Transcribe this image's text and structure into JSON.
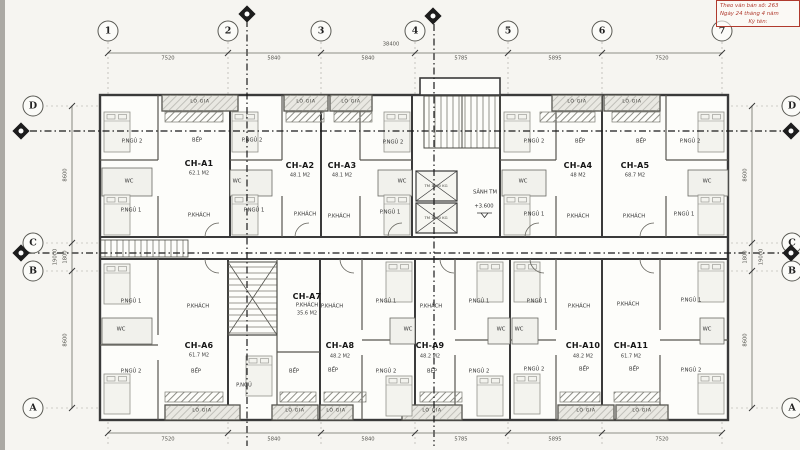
{
  "stamp": {
    "line1": "Theo văn bản số: 263",
    "line2": "Ngày 24 tháng 4 năm",
    "line3": "Ký tên:"
  },
  "grid": {
    "cols": [
      "1",
      "2",
      "3",
      "4",
      "5",
      "6",
      "7"
    ],
    "rows": [
      "D",
      "C",
      "B",
      "A"
    ],
    "col_dims": [
      "7520",
      "5840",
      "5840",
      "5785",
      "5895",
      "7520"
    ],
    "col_total": "38400",
    "row_dims": [
      "8600",
      "1800",
      "8600"
    ],
    "row_total": "19000"
  },
  "units": [
    {
      "id": "CH-A1",
      "area": "62.1 M2"
    },
    {
      "id": "CH-A2",
      "area": "48.1 M2"
    },
    {
      "id": "CH-A3",
      "area": "48.1 M2"
    },
    {
      "id": "CH-A4",
      "area": "48 M2"
    },
    {
      "id": "CH-A5",
      "area": "68.7 M2"
    },
    {
      "id": "CH-A6",
      "area": "61.7 M2"
    },
    {
      "id": "CH-A7",
      "area": "35.6 M2"
    },
    {
      "id": "CH-A8",
      "area": "48.2 M2"
    },
    {
      "id": "CH-A9",
      "area": "48.2 M2"
    },
    {
      "id": "CH-A10",
      "area": "48.2 M2"
    },
    {
      "id": "CH-A11",
      "area": "61.7 M2"
    }
  ],
  "rooms": {
    "bedroom1": "P.NGỦ 1",
    "bedroom2": "P.NGỦ 2",
    "bedroom": "P.NGỦ",
    "living": "P.KHÁCH",
    "kitchen": "BẾP",
    "wc": "WC",
    "loggia": "LÔ GIA"
  },
  "core": {
    "lobby": "SẢNH TM",
    "level": "+3.600",
    "elevator": "TM 1000 KG"
  }
}
